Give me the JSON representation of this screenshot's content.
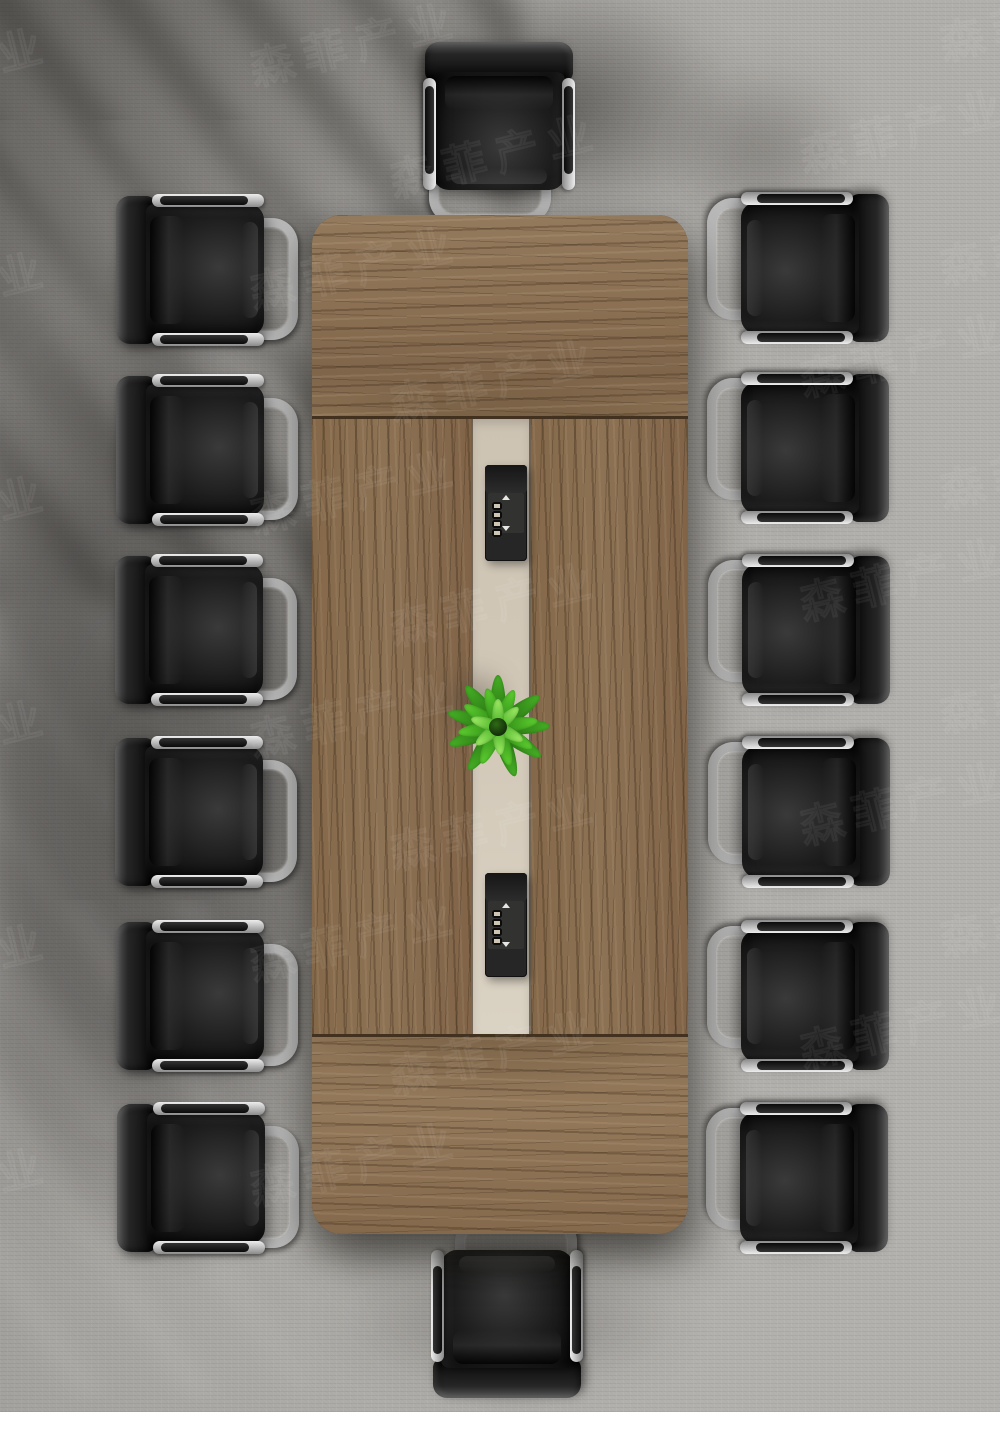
{
  "scene": {
    "type": "furniture-product-photo",
    "description": "Top-down view of a rectangular walnut conference table with a central beige cable-management strip, two black pop-up power modules, a small green plant, and 14 black leather cantilever office chairs arranged around it on gray carpet",
    "carpet_color": "#aeaca8",
    "bottom_strip_color": "#ffffff"
  },
  "table": {
    "x": 312,
    "y": 215,
    "width": 376,
    "height": 1019,
    "corner_radius": 30,
    "wood_color": "#8b7052",
    "wood_dark": "#6b5238",
    "wood_light": "#a1876a",
    "seam_color": "#42311f",
    "sections": {
      "top_height": 203,
      "middle_height": 617,
      "bottom_height": 199
    },
    "center_strip": {
      "x": 471,
      "width": 60,
      "color": "#d2c8b8"
    }
  },
  "power_modules": [
    {
      "id": "top-module",
      "x": 485,
      "y": 465,
      "width": 42,
      "height": 96,
      "socket_count": 4,
      "color": "#262626"
    },
    {
      "id": "bottom-module",
      "x": 485,
      "y": 873,
      "width": 42,
      "height": 104,
      "socket_count": 4,
      "color": "#262626"
    }
  ],
  "plant": {
    "cx": 498,
    "cy": 727,
    "leaf_colors": [
      "#2f8a16",
      "#47b026",
      "#5ecf30",
      "#7fe24a",
      "#a4ef6a"
    ],
    "core_color": "#16320a",
    "rings": [
      {
        "count": 9,
        "length": 52,
        "width": 16,
        "tip": "#47b026",
        "base": "#256d10"
      },
      {
        "count": 8,
        "length": 40,
        "width": 14,
        "tip": "#5ecf30",
        "base": "#2f8a16"
      },
      {
        "count": 6,
        "length": 28,
        "width": 12,
        "tip": "#a4ef6a",
        "base": "#4cb428"
      }
    ]
  },
  "chairs": {
    "count": 14,
    "leather_color": "#141414",
    "chrome_color": "#c6c6c6",
    "rotation_by_side": {
      "left": 0,
      "top": 90,
      "right": 180,
      "bottom": 270
    },
    "items": [
      {
        "side": "left",
        "x": 196,
        "y": 270
      },
      {
        "side": "left",
        "x": 196,
        "y": 450
      },
      {
        "side": "left",
        "x": 195,
        "y": 630
      },
      {
        "side": "left",
        "x": 195,
        "y": 812
      },
      {
        "side": "left",
        "x": 196,
        "y": 996
      },
      {
        "side": "left",
        "x": 197,
        "y": 1178
      },
      {
        "side": "right",
        "x": 809,
        "y": 268
      },
      {
        "side": "right",
        "x": 809,
        "y": 448
      },
      {
        "side": "right",
        "x": 810,
        "y": 630
      },
      {
        "side": "right",
        "x": 810,
        "y": 812
      },
      {
        "side": "right",
        "x": 809,
        "y": 996
      },
      {
        "side": "right",
        "x": 808,
        "y": 1178
      },
      {
        "side": "top",
        "x": 499,
        "y": 122
      },
      {
        "side": "bottom",
        "x": 507,
        "y": 1318
      }
    ]
  },
  "watermark": {
    "text": "森菲产业",
    "repeats_per_row": 4,
    "rows": 12,
    "first_row_y": 60,
    "row_spacing": 112,
    "alt_row_offset_x": -140,
    "angle_deg": -14
  }
}
